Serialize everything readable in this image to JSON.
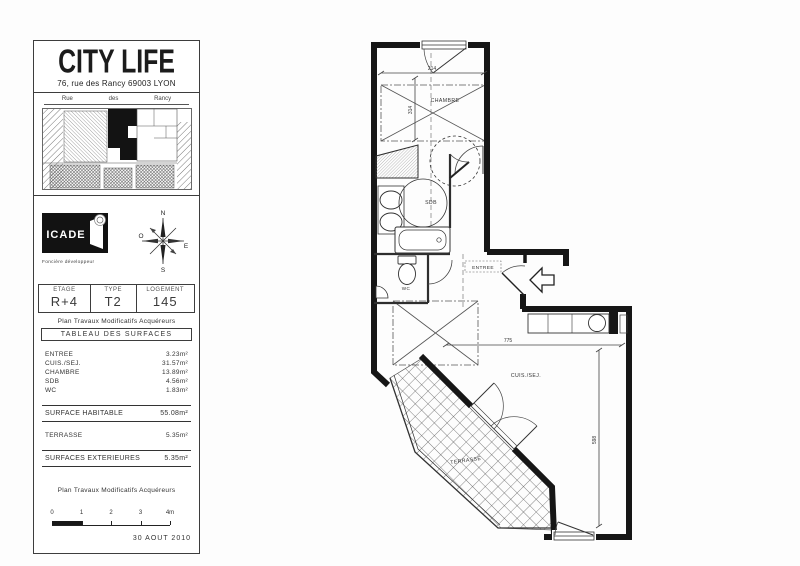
{
  "title_block": {
    "brand": {
      "name": "CITY LIFE",
      "address": "76, rue des Rancy 69003 LYON"
    },
    "site_map": {
      "street_words": [
        "Rue",
        "des",
        "Rancy"
      ]
    },
    "developer": {
      "logo": "ICADE",
      "tagline": "Foncière développeur"
    },
    "compass": {
      "n": "N",
      "s": "S",
      "e": "E",
      "w": "O"
    },
    "unit": {
      "etage_label": "ETAGE",
      "etage_value": "R+4",
      "type_label": "TYPE",
      "type_value": "T2",
      "logement_label": "LOGEMENT",
      "logement_value": "145"
    },
    "note": "Plan Travaux Modificatifs Acquéreurs",
    "surface_table": {
      "title": "TABLEAU DES SURFACES",
      "rows": [
        {
          "label": "ENTREE",
          "value": "3.23m²"
        },
        {
          "label": "CUIS./SEJ.",
          "value": "31.57m²"
        },
        {
          "label": "CHAMBRE",
          "value": "13.89m²"
        },
        {
          "label": "SDB",
          "value": "4.56m²"
        },
        {
          "label": "WC",
          "value": "1.83m²"
        }
      ],
      "habitable": {
        "label": "SURFACE HABITABLE",
        "value": "55.08m²"
      },
      "terrasse": {
        "label": "TERRASSE",
        "value": "5.35m²"
      },
      "exterieures": {
        "label": "SURFACES EXTERIEURES",
        "value": "5.35m²"
      }
    },
    "footer_note": "Plan Travaux Modificatifs Acquéreurs",
    "scale": {
      "ticks": [
        "0",
        "1",
        "2",
        "3",
        "4m"
      ]
    },
    "date": "30 AOUT 2010"
  },
  "floor_plan": {
    "rooms": {
      "chambre": "CHAMBRE",
      "sdb": "SDB",
      "wc": "WC",
      "entree": "ENTREE",
      "sejour": "CUIS./SEJ.",
      "terrasse": "TERRASSE"
    },
    "dims": {
      "chambre_w": "214",
      "chambre_h": "314",
      "sejour_w": "775",
      "sejour_h": "598"
    }
  }
}
